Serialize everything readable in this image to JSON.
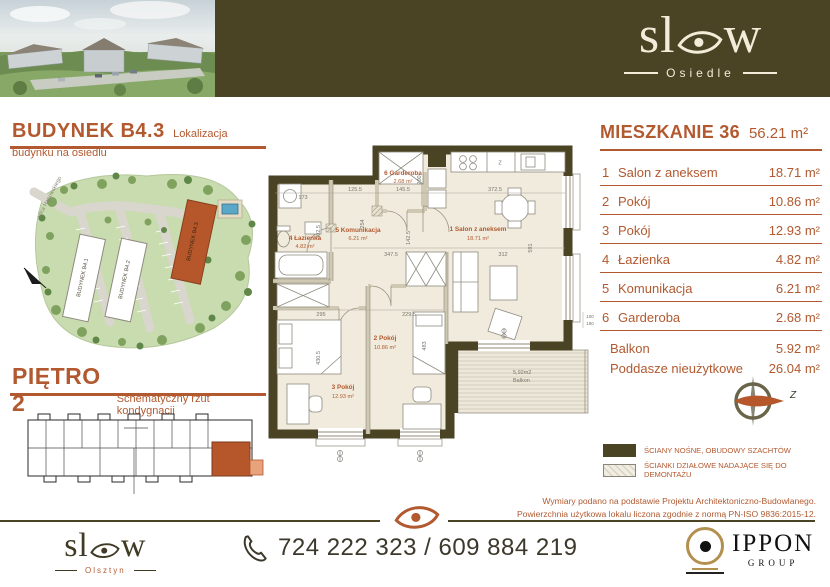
{
  "colors": {
    "olive": "#4a4324",
    "rust": "#b2592f",
    "cream": "#f2ecd9",
    "floor": "#f0ebdd"
  },
  "header": {
    "brand_left": "sl",
    "brand_right": "w",
    "brand_sub": "Osiedle"
  },
  "budynek": {
    "title": "BUDYNEK B4.3",
    "subtitle": "Lokalizacja budynku na osiedlu",
    "street": "ulica Hanowskiego",
    "b1": "BUDYNEK B4.1",
    "b2": "BUDYNEK B4.2",
    "b3": "BUDYNEK B4.3"
  },
  "pietro": {
    "title": "PIĘTRO 2",
    "subtitle": "Schematyczny rzut kondygnacji"
  },
  "apartment": {
    "title": "MIESZKANIE 36",
    "total": "56.21 m²",
    "rooms": [
      {
        "num": "1",
        "name": "Salon z aneksem",
        "area": "18.71 m²"
      },
      {
        "num": "2",
        "name": "Pokój",
        "area": "10.86 m²"
      },
      {
        "num": "3",
        "name": "Pokój",
        "area": "12.93 m²"
      },
      {
        "num": "4",
        "name": "Łazienka",
        "area": "4.82 m²"
      },
      {
        "num": "5",
        "name": "Komunikacja",
        "area": "6.21 m²"
      },
      {
        "num": "6",
        "name": "Garderoba",
        "area": "2.68 m²"
      }
    ],
    "extras": [
      {
        "name": "Balkon",
        "area": "5.92 m²"
      },
      {
        "name": "Poddasze nieużytkowe",
        "area": "26.04 m²"
      }
    ]
  },
  "plan": {
    "labels": [
      {
        "t": "1 Salon z aneksem",
        "a": "18.71 m²"
      },
      {
        "t": "2 Pokój",
        "a": "10.86 m²"
      },
      {
        "t": "3 Pokój",
        "a": "12.93 m²"
      },
      {
        "t": "4 Łazienka",
        "a": "4.82 m²"
      },
      {
        "t": "5 Komunikacja",
        "a": "6.21 m²"
      },
      {
        "t": "6 Garderoba",
        "a": "2.68 m²"
      }
    ],
    "balcony": {
      "area": "5,92m2",
      "name": "Balkon"
    },
    "kitchen_sink": "Z",
    "dims": [
      "173",
      "125.5",
      "145.5",
      "372.5",
      "200",
      "302.5",
      "254",
      "142.5",
      "347.5",
      "312",
      "591",
      "295",
      "229.5",
      "430.5",
      "483",
      "100",
      "180"
    ]
  },
  "compass": {
    "label": "Z"
  },
  "legend": [
    {
      "label": "ŚCIANY NOŚNE, OBUDOWY SZACHTÓW"
    },
    {
      "label": "ŚCIANKI DZIAŁOWE NADAJĄCE SIĘ DO DEMONTAŻU"
    }
  ],
  "notes": [
    "Wymiary podano na podstawie Projektu Architektoniczno-Budowlanego.",
    "Powierzchnia użytkowa lokalu liczona zgodnie z normą PN-ISO 9836:2015-12."
  ],
  "footer": {
    "brand_left": "sl",
    "brand_right": "w",
    "brand_sub": "Olsztyn",
    "phone": "724 222 323 / 609 884 219",
    "partner": "IPPON",
    "partner_sub": "GROUP"
  }
}
